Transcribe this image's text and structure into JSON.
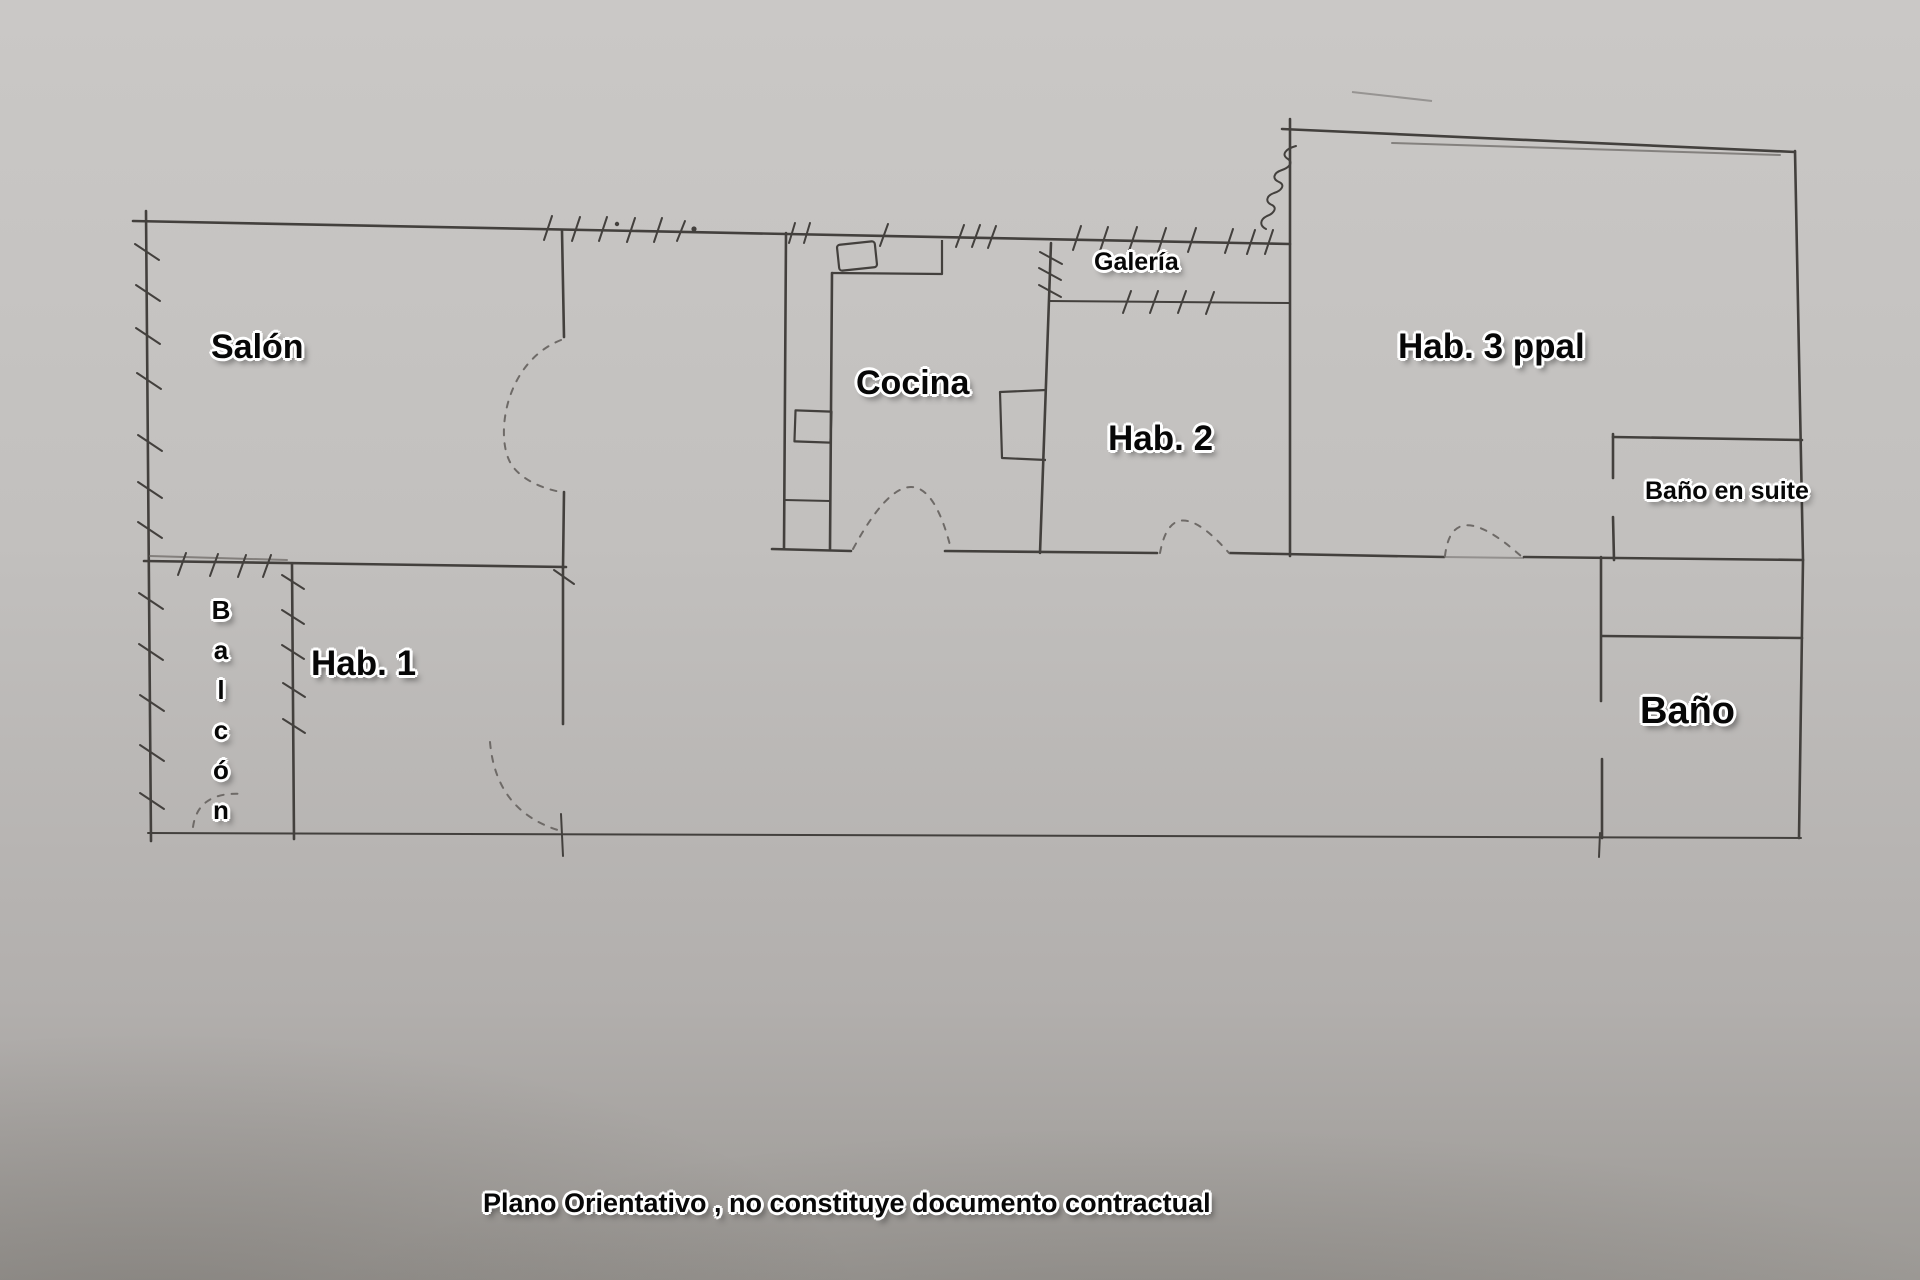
{
  "plan": {
    "rooms": {
      "salon": "Salón",
      "cocina": "Cocina",
      "galeria": "Galería",
      "hab2": "Hab. 2",
      "hab3": "Hab. 3 ppal",
      "bano_suite": "Baño en suite",
      "hab1": "Hab. 1",
      "balcon": "B\na\nl\nc\nó\nn",
      "bano": "Baño"
    },
    "footer": {
      "disclaimer": "Plano Orientativo , no constituye documento contractual"
    },
    "colors": {
      "paper_top": "#cac8c6",
      "paper_mid": "#c2c0be",
      "paper_low": "#b2afad",
      "paper_bottom": "#9c9995",
      "ink": "#43403d",
      "ink_light": "#6e6a67",
      "label": "#070707",
      "halo": "#ffffff"
    }
  }
}
